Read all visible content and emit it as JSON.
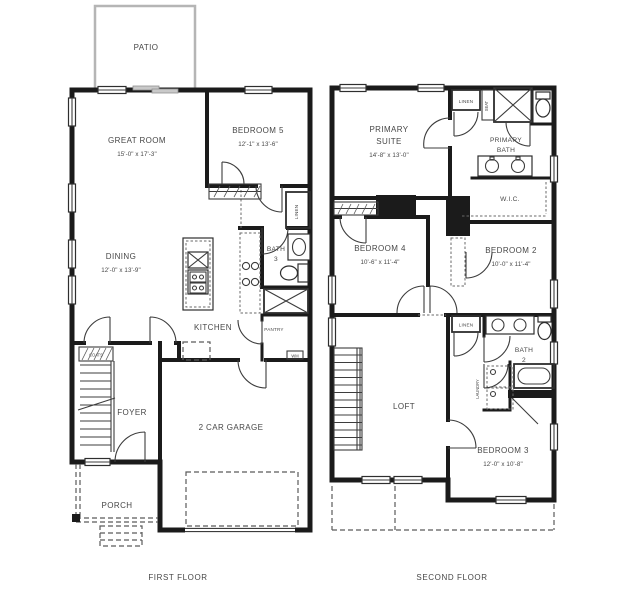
{
  "colors": {
    "wall": "#1b1b1b",
    "patio_line": "#b5b5b5",
    "text": "#474747",
    "background": "#ffffff"
  },
  "first_floor": {
    "caption": "FIRST FLOOR",
    "patio": "PATIO",
    "great_room": {
      "name": "GREAT ROOM",
      "dims": "15'-0\" x 17'-3\""
    },
    "bedroom5": {
      "name": "BEDROOM 5",
      "dims": "12'-1\" x 13'-6\""
    },
    "dining": {
      "name": "DINING",
      "dims": "12'-0\" x 13'-9\""
    },
    "kitchen": "KITCHEN",
    "pantry": "PANTRY",
    "bath3": {
      "name": "BATH",
      "num": "3"
    },
    "linen": "LINEN",
    "coats": "COATS",
    "foyer": "FOYER",
    "garage": "2 CAR GARAGE",
    "porch": "PORCH",
    "wm": "WM"
  },
  "second_floor": {
    "caption": "SECOND FLOOR",
    "primary_suite": {
      "l1": "PRIMARY",
      "l2": "SUITE",
      "dims": "14'-8\" x 13'-0\""
    },
    "primary_bath": {
      "l1": "PRIMARY",
      "l2": "BATH"
    },
    "wic": "W.I.C.",
    "linen_top": "LINEN",
    "seat": "SEAT",
    "bedroom4": {
      "name": "BEDROOM 4",
      "dims": "10'-6\" x 11'-4\""
    },
    "bedroom2": {
      "name": "BEDROOM 2",
      "dims": "10'-0\" x 11'-4\""
    },
    "linen_mid": "LINEN",
    "bath2": {
      "name": "BATH",
      "num": "2"
    },
    "laundry": "LAUNDRY",
    "loft": "LOFT",
    "bedroom3": {
      "name": "BEDROOM 3",
      "dims": "12'-0\" x 10'-8\""
    }
  }
}
